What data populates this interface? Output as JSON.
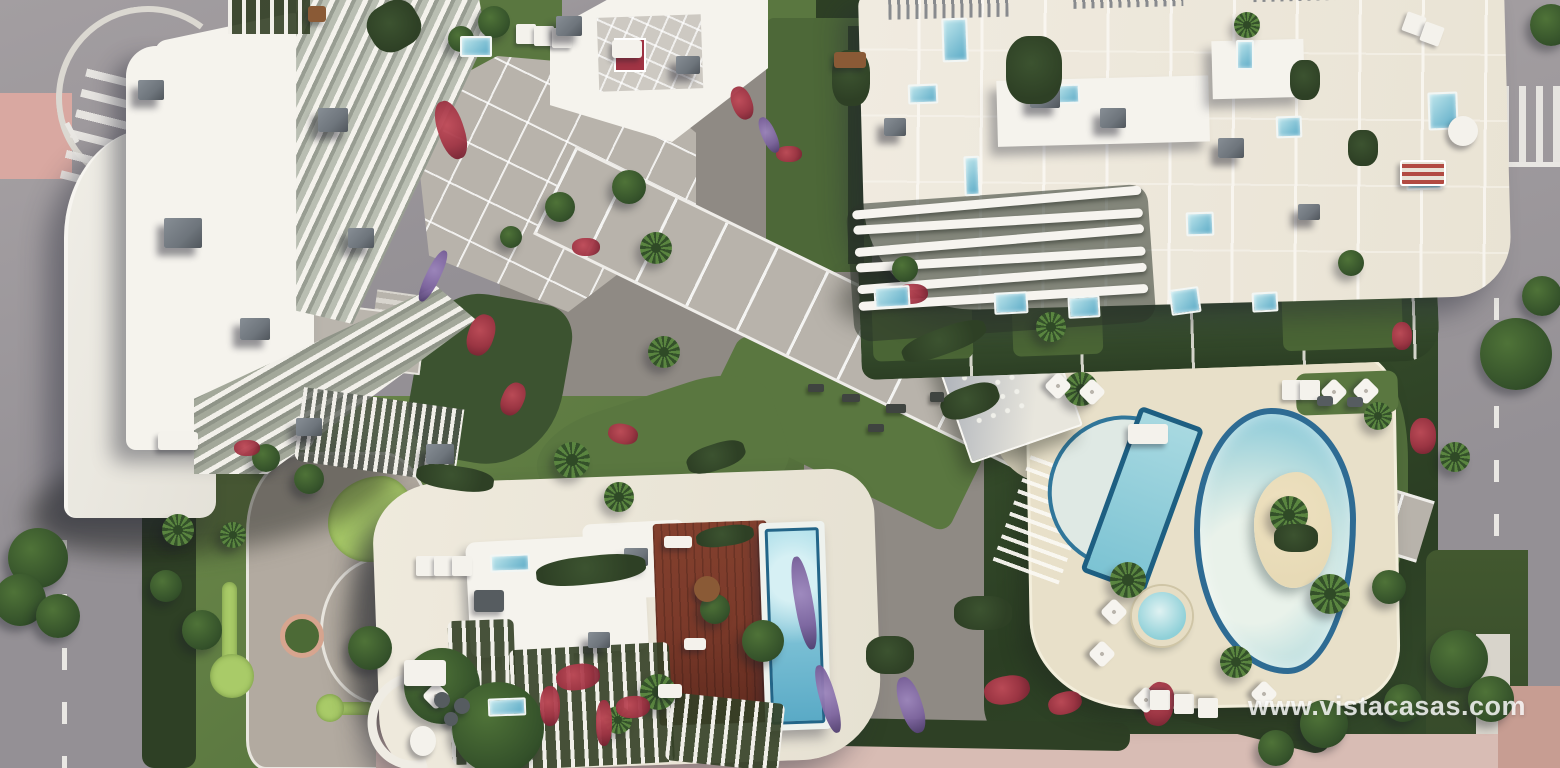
{
  "meta": {
    "type": "architectural-aerial-render",
    "subject": "top-down 3D render of a residential complex with three apartment buildings, communal lagoon pool, lap pool, rooftop pool, wooden deck, gardens and surrounding roads"
  },
  "watermark": {
    "text": "www.vistacasas.com"
  },
  "scene": {
    "areas": [
      {
        "name": "building-north-west"
      },
      {
        "name": "building-north-east"
      },
      {
        "name": "building-south"
      },
      {
        "name": "communal-lagoon-pool"
      },
      {
        "name": "lap-pool"
      },
      {
        "name": "kids-spa-pool"
      },
      {
        "name": "rooftop-infinity-pool"
      },
      {
        "name": "rooftop-wooden-deck"
      },
      {
        "name": "central-walkway"
      },
      {
        "name": "upper-plaza"
      },
      {
        "name": "putting-green-garden"
      },
      {
        "name": "outdoor-gym-lawn"
      },
      {
        "name": "pool-sun-deck"
      },
      {
        "name": "left-road"
      },
      {
        "name": "right-road"
      }
    ],
    "colors": {
      "road": "#949095",
      "road_light": "#a39ea1",
      "sidewalk": "#bab5b0",
      "lane_mark": "#e9e7e3",
      "bike_lane": "#d9a8a1",
      "crosswalk": "#eceae6",
      "plaza": "#b8b3ab",
      "plaza_line": "#efede9",
      "gravel": "#b2aaa0",
      "lawn": "#5a7740",
      "lawn_light": "#6d8a4a",
      "lawn_dark": "#4a6233",
      "hedge": "#2e4025",
      "hedge_light": "#3c5330",
      "putting_green": "#a9cb68",
      "roof_white": "#f5f3ed",
      "roof_cream": "#e9e3d4",
      "terrace_sand": "#e9e2d0",
      "deck_sand": "#e8e0c9",
      "ac_grey": "#6e757c",
      "ac_dark": "#50565c",
      "wood_deck": "#7b3a2a",
      "wood_dark": "#5f2a1e",
      "pool_rim": "#236588",
      "pool_water": "#8ecbd9",
      "pool_light": "#cfe9e9",
      "pool_deep": "#5aaac6",
      "island_sand": "#e7dab6",
      "flower_red": "#a03444",
      "flower_purple": "#7c639e",
      "tree_green": "#4f7338",
      "tree_dark": "#34512a",
      "palm_green": "#5a8540",
      "shadow": "rgba(38,40,54,0.42)",
      "pink_pave": "#d8bcb4",
      "watermark": "rgba(255,255,255,0.82)"
    },
    "decorations": {
      "trees": [
        {
          "x": 8,
          "y": 528,
          "r": 30
        },
        {
          "x": -6,
          "y": 574,
          "r": 26
        },
        {
          "x": 36,
          "y": 594,
          "r": 22
        },
        {
          "x": 150,
          "y": 570,
          "r": 16
        },
        {
          "x": 182,
          "y": 610,
          "r": 20
        },
        {
          "x": 404,
          "y": 648,
          "r": 38
        },
        {
          "x": 452,
          "y": 682,
          "r": 46
        },
        {
          "x": 348,
          "y": 626,
          "r": 22
        },
        {
          "x": 252,
          "y": 444,
          "r": 14
        },
        {
          "x": 294,
          "y": 464,
          "r": 15
        },
        {
          "x": 448,
          "y": 26,
          "r": 13
        },
        {
          "x": 478,
          "y": 6,
          "r": 16
        },
        {
          "x": 545,
          "y": 192,
          "r": 15
        },
        {
          "x": 612,
          "y": 170,
          "r": 17
        },
        {
          "x": 500,
          "y": 226,
          "r": 11
        },
        {
          "x": 742,
          "y": 620,
          "r": 21
        },
        {
          "x": 700,
          "y": 594,
          "r": 15
        },
        {
          "x": 1430,
          "y": 630,
          "r": 29
        },
        {
          "x": 1468,
          "y": 676,
          "r": 23
        },
        {
          "x": 1384,
          "y": 684,
          "r": 19
        },
        {
          "x": 1480,
          "y": 318,
          "r": 36
        },
        {
          "x": 1522,
          "y": 276,
          "r": 20
        },
        {
          "x": 1530,
          "y": 4,
          "r": 21
        },
        {
          "x": 892,
          "y": 256,
          "r": 13
        },
        {
          "x": 1338,
          "y": 250,
          "r": 13
        },
        {
          "x": 1372,
          "y": 570,
          "r": 17
        },
        {
          "x": 1300,
          "y": 700,
          "r": 24
        },
        {
          "x": 1258,
          "y": 730,
          "r": 18
        }
      ],
      "palms": [
        {
          "x": 640,
          "y": 232,
          "r": 16
        },
        {
          "x": 648,
          "y": 336,
          "r": 16
        },
        {
          "x": 554,
          "y": 442,
          "r": 18
        },
        {
          "x": 604,
          "y": 482,
          "r": 15
        },
        {
          "x": 640,
          "y": 674,
          "r": 18
        },
        {
          "x": 604,
          "y": 706,
          "r": 14
        },
        {
          "x": 162,
          "y": 514,
          "r": 16
        },
        {
          "x": 220,
          "y": 522,
          "r": 13
        },
        {
          "x": 1036,
          "y": 312,
          "r": 15
        },
        {
          "x": 1064,
          "y": 372,
          "r": 17
        },
        {
          "x": 1110,
          "y": 562,
          "r": 18
        },
        {
          "x": 1310,
          "y": 574,
          "r": 20
        },
        {
          "x": 1220,
          "y": 646,
          "r": 16
        },
        {
          "x": 1364,
          "y": 402,
          "r": 14
        },
        {
          "x": 1234,
          "y": 12,
          "r": 13
        },
        {
          "x": 1440,
          "y": 442,
          "r": 15
        },
        {
          "x": 1270,
          "y": 496,
          "r": 19
        }
      ],
      "flowers": [
        {
          "x": 438,
          "y": 100,
          "w": 26,
          "h": 60,
          "rot": -18
        },
        {
          "x": 468,
          "y": 314,
          "w": 26,
          "h": 42,
          "rot": 18
        },
        {
          "x": 502,
          "y": 382,
          "w": 22,
          "h": 34,
          "rot": 24
        },
        {
          "x": 572,
          "y": 238,
          "w": 28,
          "h": 18,
          "rot": 0
        },
        {
          "x": 608,
          "y": 424,
          "w": 30,
          "h": 20,
          "rot": 12
        },
        {
          "x": 556,
          "y": 664,
          "w": 44,
          "h": 26,
          "rot": -8
        },
        {
          "x": 616,
          "y": 696,
          "w": 34,
          "h": 22,
          "rot": -4
        },
        {
          "x": 894,
          "y": 284,
          "w": 34,
          "h": 20,
          "rot": -4
        },
        {
          "x": 984,
          "y": 676,
          "w": 46,
          "h": 28,
          "rot": -10
        },
        {
          "x": 1048,
          "y": 692,
          "w": 34,
          "h": 22,
          "rot": -16
        },
        {
          "x": 1144,
          "y": 682,
          "w": 30,
          "h": 44,
          "rot": 10
        },
        {
          "x": 776,
          "y": 146,
          "w": 26,
          "h": 16,
          "rot": 0
        },
        {
          "x": 1392,
          "y": 322,
          "w": 20,
          "h": 28,
          "rot": 0
        },
        {
          "x": 732,
          "y": 86,
          "w": 20,
          "h": 34,
          "rot": -20
        },
        {
          "x": 234,
          "y": 440,
          "w": 26,
          "h": 16,
          "rot": 0
        },
        {
          "x": 540,
          "y": 686,
          "w": 20,
          "h": 40,
          "rot": 0
        },
        {
          "x": 596,
          "y": 700,
          "w": 16,
          "h": 46,
          "rot": 0
        },
        {
          "x": 1410,
          "y": 418,
          "w": 26,
          "h": 36,
          "rot": 0
        },
        {
          "x": 795,
          "y": 556,
          "w": 18,
          "h": 94,
          "rot": -10,
          "color": "purple"
        },
        {
          "x": 820,
          "y": 664,
          "w": 16,
          "h": 70,
          "rot": -16,
          "color": "purple"
        },
        {
          "x": 426,
          "y": 248,
          "w": 14,
          "h": 56,
          "rot": 26,
          "color": "purple"
        },
        {
          "x": 900,
          "y": 676,
          "w": 22,
          "h": 58,
          "rot": -18,
          "color": "purple"
        },
        {
          "x": 762,
          "y": 116,
          "w": 14,
          "h": 38,
          "rot": -24,
          "color": "purple"
        }
      ],
      "mini_pools": [
        {
          "x": 874,
          "y": 286,
          "w": 36,
          "h": 22,
          "rot": -3
        },
        {
          "x": 994,
          "y": 292,
          "w": 34,
          "h": 22,
          "rot": -3
        },
        {
          "x": 1068,
          "y": 296,
          "w": 32,
          "h": 22,
          "rot": -3
        },
        {
          "x": 1170,
          "y": 288,
          "w": 30,
          "h": 26,
          "rot": -8
        },
        {
          "x": 1252,
          "y": 292,
          "w": 26,
          "h": 20,
          "rot": -3
        },
        {
          "x": 460,
          "y": 36,
          "w": 32,
          "h": 21,
          "rot": 0
        },
        {
          "x": 490,
          "y": 554,
          "w": 40,
          "h": 18,
          "rot": -2
        },
        {
          "x": 488,
          "y": 698,
          "w": 38,
          "h": 18,
          "rot": -2
        },
        {
          "x": 942,
          "y": 18,
          "w": 26,
          "h": 44,
          "rot": -2
        },
        {
          "x": 908,
          "y": 84,
          "w": 30,
          "h": 20,
          "rot": -2
        },
        {
          "x": 1054,
          "y": 84,
          "w": 26,
          "h": 20,
          "rot": -2
        },
        {
          "x": 1236,
          "y": 40,
          "w": 18,
          "h": 30,
          "rot": 0
        },
        {
          "x": 1276,
          "y": 116,
          "w": 26,
          "h": 22,
          "rot": -2
        },
        {
          "x": 964,
          "y": 156,
          "w": 16,
          "h": 40,
          "rot": -2
        },
        {
          "x": 1186,
          "y": 212,
          "w": 28,
          "h": 24,
          "rot": -2
        },
        {
          "x": 1428,
          "y": 92,
          "w": 30,
          "h": 38,
          "rot": -2
        },
        {
          "x": 1406,
          "y": 164,
          "w": 36,
          "h": 26,
          "rot": -2
        }
      ],
      "umbrellas": [
        {
          "x": 1048,
          "y": 376
        },
        {
          "x": 1082,
          "y": 382
        },
        {
          "x": 1104,
          "y": 602
        },
        {
          "x": 1092,
          "y": 644
        },
        {
          "x": 1136,
          "y": 690
        },
        {
          "x": 1254,
          "y": 684
        },
        {
          "x": 426,
          "y": 686
        },
        {
          "x": 1324,
          "y": 382
        },
        {
          "x": 1356,
          "y": 381
        }
      ],
      "loungers": [
        {
          "x": 1282,
          "y": 380,
          "rot": 0
        },
        {
          "x": 1300,
          "y": 380,
          "rot": 0
        },
        {
          "x": 1150,
          "y": 690,
          "rot": 90
        },
        {
          "x": 1174,
          "y": 694,
          "rot": 90
        },
        {
          "x": 1198,
          "y": 698,
          "rot": 90
        },
        {
          "x": 416,
          "y": 556,
          "rot": 0
        },
        {
          "x": 434,
          "y": 556,
          "rot": 0
        },
        {
          "x": 452,
          "y": 556,
          "rot": 0
        },
        {
          "x": 1404,
          "y": 14,
          "rot": 20
        },
        {
          "x": 1422,
          "y": 24,
          "rot": 20
        },
        {
          "x": 516,
          "y": 24,
          "rot": 0
        },
        {
          "x": 534,
          "y": 26,
          "rot": 0
        },
        {
          "x": 552,
          "y": 28,
          "rot": 0
        }
      ],
      "ac_units": [
        {
          "x": 164,
          "y": 218,
          "w": 38,
          "h": 30
        },
        {
          "x": 318,
          "y": 108,
          "w": 30,
          "h": 24
        },
        {
          "x": 240,
          "y": 318,
          "w": 30,
          "h": 22
        },
        {
          "x": 138,
          "y": 80,
          "w": 26,
          "h": 20
        },
        {
          "x": 348,
          "y": 228,
          "w": 26,
          "h": 20
        },
        {
          "x": 296,
          "y": 418,
          "w": 26,
          "h": 18
        },
        {
          "x": 426,
          "y": 444,
          "w": 28,
          "h": 20
        },
        {
          "x": 1030,
          "y": 84,
          "w": 30,
          "h": 24
        },
        {
          "x": 1100,
          "y": 108,
          "w": 26,
          "h": 20
        },
        {
          "x": 884,
          "y": 118,
          "w": 22,
          "h": 18
        },
        {
          "x": 1218,
          "y": 138,
          "w": 26,
          "h": 20
        },
        {
          "x": 1298,
          "y": 204,
          "w": 22,
          "h": 16
        },
        {
          "x": 624,
          "y": 548,
          "w": 24,
          "h": 18
        },
        {
          "x": 588,
          "y": 632,
          "w": 22,
          "h": 16
        },
        {
          "x": 556,
          "y": 16,
          "w": 26,
          "h": 20
        },
        {
          "x": 676,
          "y": 56,
          "w": 24,
          "h": 18
        }
      ],
      "shrubs": [
        {
          "x": 686,
          "y": 444,
          "w": 60,
          "h": 26,
          "rot": -18
        },
        {
          "x": 536,
          "y": 556,
          "w": 110,
          "h": 28,
          "rot": -6
        },
        {
          "x": 900,
          "y": 328,
          "w": 88,
          "h": 26,
          "rot": -20
        },
        {
          "x": 1006,
          "y": 36,
          "w": 56,
          "h": 68,
          "rot": 0
        },
        {
          "x": 832,
          "y": 50,
          "w": 38,
          "h": 56,
          "rot": 0
        },
        {
          "x": 416,
          "y": 466,
          "w": 78,
          "h": 24,
          "rot": 8
        },
        {
          "x": 696,
          "y": 526,
          "w": 58,
          "h": 20,
          "rot": -8
        },
        {
          "x": 866,
          "y": 636,
          "w": 48,
          "h": 38,
          "rot": 0
        },
        {
          "x": 954,
          "y": 596,
          "w": 58,
          "h": 34,
          "rot": 0
        },
        {
          "x": 1274,
          "y": 524,
          "w": 44,
          "h": 28,
          "rot": 0
        },
        {
          "x": 368,
          "y": 2,
          "w": 52,
          "h": 48,
          "rot": -30
        },
        {
          "x": 1290,
          "y": 60,
          "w": 30,
          "h": 40,
          "rot": 0
        },
        {
          "x": 1348,
          "y": 130,
          "w": 30,
          "h": 36,
          "rot": 0
        },
        {
          "x": 940,
          "y": 386,
          "w": 60,
          "h": 30,
          "rot": -19
        }
      ],
      "gym_items": [
        {
          "x": 808,
          "y": 384,
          "w": 16,
          "h": 8
        },
        {
          "x": 842,
          "y": 394,
          "w": 18,
          "h": 8
        },
        {
          "x": 886,
          "y": 404,
          "w": 20,
          "h": 9
        },
        {
          "x": 930,
          "y": 392,
          "w": 14,
          "h": 10
        },
        {
          "x": 868,
          "y": 424,
          "w": 16,
          "h": 8
        }
      ],
      "furniture": [
        {
          "x": 404,
          "y": 660,
          "w": 42,
          "h": 26,
          "variant": "white"
        },
        {
          "x": 474,
          "y": 590,
          "w": 30,
          "h": 22,
          "variant": "dark"
        },
        {
          "x": 434,
          "y": 692,
          "w": 16,
          "h": 16,
          "variant": "dark",
          "round": true
        },
        {
          "x": 454,
          "y": 698,
          "w": 16,
          "h": 16,
          "variant": "dark",
          "round": true
        },
        {
          "x": 444,
          "y": 712,
          "w": 14,
          "h": 14,
          "variant": "dark",
          "round": true
        },
        {
          "x": 410,
          "y": 726,
          "w": 26,
          "h": 30,
          "variant": "white",
          "round": true
        },
        {
          "x": 664,
          "y": 536,
          "w": 28,
          "h": 12,
          "variant": "white"
        },
        {
          "x": 684,
          "y": 638,
          "w": 22,
          "h": 12,
          "variant": "white"
        },
        {
          "x": 658,
          "y": 684,
          "w": 24,
          "h": 14,
          "variant": "white"
        },
        {
          "x": 694,
          "y": 576,
          "w": 26,
          "h": 26,
          "variant": "brown",
          "round": true
        },
        {
          "x": 834,
          "y": 52,
          "w": 32,
          "h": 16,
          "variant": "brown"
        },
        {
          "x": 308,
          "y": 6,
          "w": 18,
          "h": 16,
          "variant": "brown"
        },
        {
          "x": 1400,
          "y": 160,
          "w": 46,
          "h": 26,
          "variant": "rug"
        },
        {
          "x": 1448,
          "y": 116,
          "w": 30,
          "h": 30,
          "variant": "white",
          "round": true
        },
        {
          "x": 612,
          "y": 40,
          "w": 30,
          "h": 18,
          "variant": "white"
        },
        {
          "x": 1128,
          "y": 424,
          "w": 40,
          "h": 20,
          "variant": "white"
        },
        {
          "x": 158,
          "y": 432,
          "w": 40,
          "h": 18,
          "variant": "white"
        },
        {
          "x": 1317,
          "y": 396,
          "w": 16,
          "h": 10,
          "variant": "dark"
        },
        {
          "x": 1347,
          "y": 397,
          "w": 16,
          "h": 10,
          "variant": "dark"
        }
      ]
    }
  }
}
